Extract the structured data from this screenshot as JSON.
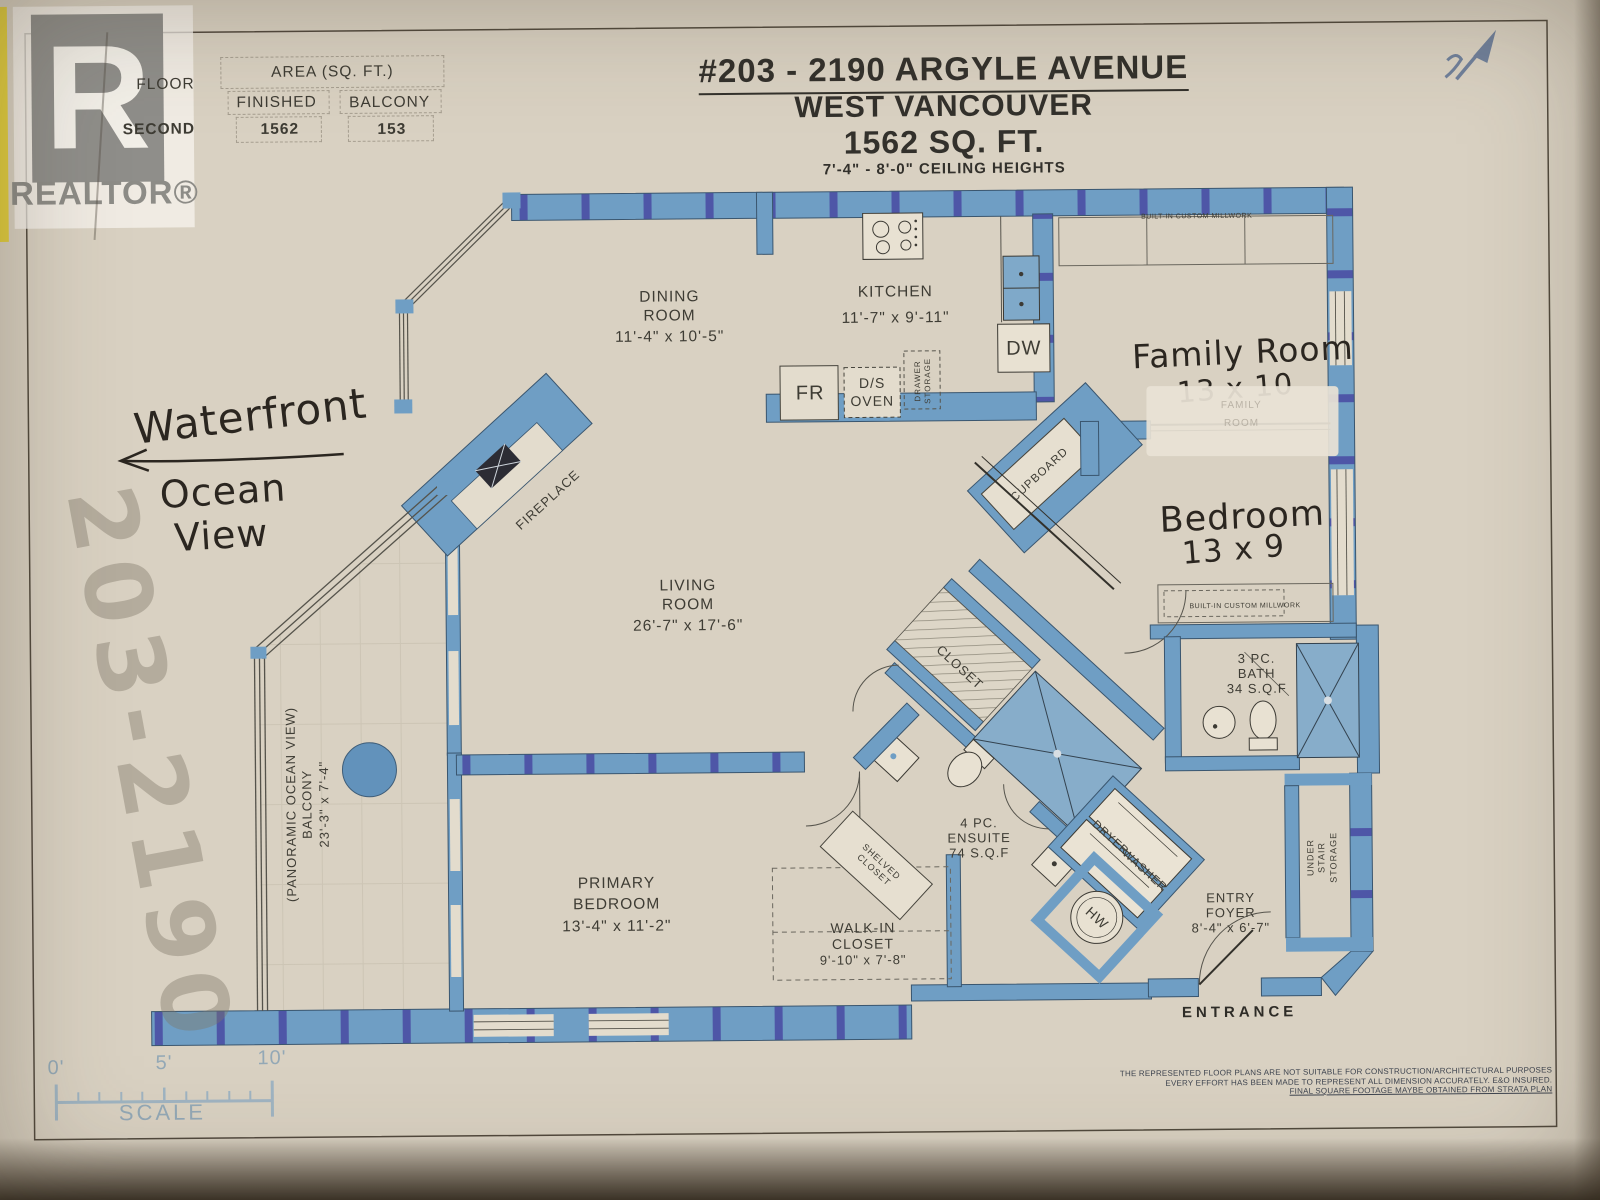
{
  "colors": {
    "paper": "#d9d1c2",
    "wall_blue": "#6f9ec4",
    "stud_indigo": "#4643a0",
    "ink": "#33312b",
    "hand_ink": "#2b2620",
    "scale_blue": "#9fb4c2",
    "highlight_yellow": "#e3cf3e"
  },
  "branding": {
    "logo_letter": "R",
    "wordmark": "REALTOR®"
  },
  "area_table": {
    "floor_label": "FLOOR",
    "floor_value": "SECOND",
    "area_header": "AREA (SQ. FT.)",
    "finished_label": "FINISHED",
    "finished_value": "1562",
    "balcony_label": "BALCONY",
    "balcony_value": "153"
  },
  "title": {
    "address": "#203 - 2190 ARGYLE AVENUE",
    "city": "WEST VANCOUVER",
    "area": "1562 SQ. FT.",
    "ceiling": "7'-4\" - 8'-0\" CEILING HEIGHTS"
  },
  "handwritten": {
    "waterfront": "Waterfront",
    "ocean": "Ocean",
    "view": "View",
    "family_room": "Family Room",
    "family_dims": "13 x 10",
    "bedroom": "Bedroom",
    "bedroom_dims": "13 x 9",
    "bleed_number": "203-2190",
    "corner_mark_icon": "north-arrow-mark"
  },
  "rooms": {
    "dining": {
      "l1": "DINING",
      "l2": "ROOM",
      "dims": "11'-4\" x 10'-5\""
    },
    "kitchen": {
      "l1": "KITCHEN",
      "dims": "11'-7\" x 9'-11\""
    },
    "living": {
      "l1": "LIVING",
      "l2": "ROOM",
      "dims": "26'-7\" x 17'-6\""
    },
    "primary": {
      "l1": "PRIMARY",
      "l2": "BEDROOM",
      "dims": "13'-4\" x 11'-2\""
    },
    "walkin": {
      "l1": "WALK-IN",
      "l2": "CLOSET",
      "dims": "9'-10\" x 7'-8\""
    },
    "ensuite": {
      "l1": "4 PC.",
      "l2": "ENSUITE",
      "dims": "74 S.Q.F"
    },
    "bath": {
      "l1": "3 PC.",
      "l2": "BATH",
      "dims": "34 S.Q.F"
    },
    "entry": {
      "l1": "ENTRY",
      "l2": "FOYER",
      "dims": "8'-4\" x 6'-7\""
    },
    "balcony": {
      "l1": "(PANORAMIC OCEAN VIEW)",
      "l2": "BALCONY",
      "dims": "23'-3\" x 7'-4\""
    }
  },
  "fixtures": {
    "fireplace": "FIREPLACE",
    "closet": "CLOSET",
    "shelved1": "SHELVED",
    "shelved2": "CLOSET",
    "cupboard": "CUPBOARD",
    "drawer1": "DRAWER",
    "drawer2": "STORAGE",
    "fr": "FR",
    "oven1": "D/S",
    "oven2": "OVEN",
    "dw": "DW",
    "washer": "WASHER",
    "dryer": "DRYER",
    "hw": "HW",
    "millwork_top": "BUILT-IN CUSTOM MILLWORK",
    "millwork_bedroom": "BUILT-IN CUSTOM MILLWORK",
    "under1": "UNDER",
    "under2": "STAIR",
    "under3": "STORAGE",
    "entrance": "ENTRANCE",
    "ghost1": "FAMILY",
    "ghost2": "ROOM"
  },
  "scale_bar": {
    "t0": "0'",
    "t5": "5'",
    "t10": "10'",
    "label": "SCALE"
  },
  "disclaimer": {
    "l1": "THE REPRESENTED FLOOR PLANS ARE NOT SUITABLE FOR CONSTRUCTION/ARCHITECTURAL PURPOSES",
    "l2": "EVERY EFFORT HAS BEEN MADE TO REPRESENT ALL DIMENSION ACCURATELY. E&O INSURED.",
    "l3": "FINAL SQUARE FOOTAGE MAYBE OBTAINED FROM STRATA PLAN"
  }
}
